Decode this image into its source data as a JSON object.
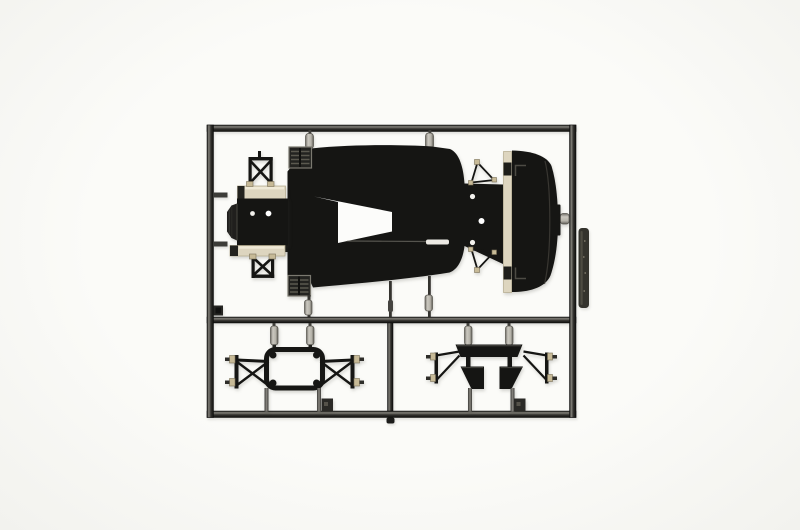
{
  "scene": {
    "label": "photograph of a black plastic model-kit sprue (parts tree) on a white background",
    "camera": "top-down product photo"
  },
  "parts": {
    "frame": "rectangular sprue runner frame",
    "top_rail": "top runner rail",
    "bottom_rail": "bottom runner rail",
    "left_rail": "left runner rail",
    "right_rail": "right runner rail",
    "middle_rail": "middle runner rail",
    "divider": "vertical divider runner",
    "chassis": "chassis floor pan part with cutout",
    "cockpit": "front cockpit / bulkhead section part",
    "nose": "front nose block",
    "front_upper_wishbone": "front upper suspension wishbone",
    "front_lower_wishbone": "front lower suspension wishbone",
    "grille_top": "louvered vent insert (top)",
    "grille_bottom": "louvered vent insert (bottom)",
    "rear_bulkhead": "rear bulkhead plate with holes",
    "rear_upper_wishbone": "rear upper suspension wishbone",
    "rear_lower_wishbone": "rear lower suspension wishbone",
    "rear_cowl": "rounded rear cowl panel part",
    "subframe_left": "tubular subframe part (hexagonal ring)",
    "subframe_right": "rear subframe part with mounting plates",
    "tag": "embossed part-number tag",
    "gate": "sprue gate",
    "mold_tab": "square mold tab"
  },
  "colors": {
    "background": "#fbfbf8",
    "vignette_edge": "#f2f2ee",
    "plastic": "#151513",
    "plastic_soft": "#201f1d",
    "rail_mid": "#62605b",
    "rail_dark": "#1a1a18",
    "gate_hi": "#cbc8c0",
    "gate_mid": "#96948c",
    "gate_dark": "#55534c",
    "cream": "#ddd5bf",
    "cream_hi": "#efe9d6",
    "cream_dark": "#b3a98c",
    "cap_tan": "#c7ba97",
    "grille_line": "#5b594f",
    "grille_frame": "#7b7970",
    "seam": "#8a8880",
    "hole_white": "#ffffff",
    "tag": "#34332d",
    "tag_sheen": "#5a574b",
    "notch_white": "#fcfcfa",
    "shadow": "rgba(70,68,60,0.22)"
  }
}
